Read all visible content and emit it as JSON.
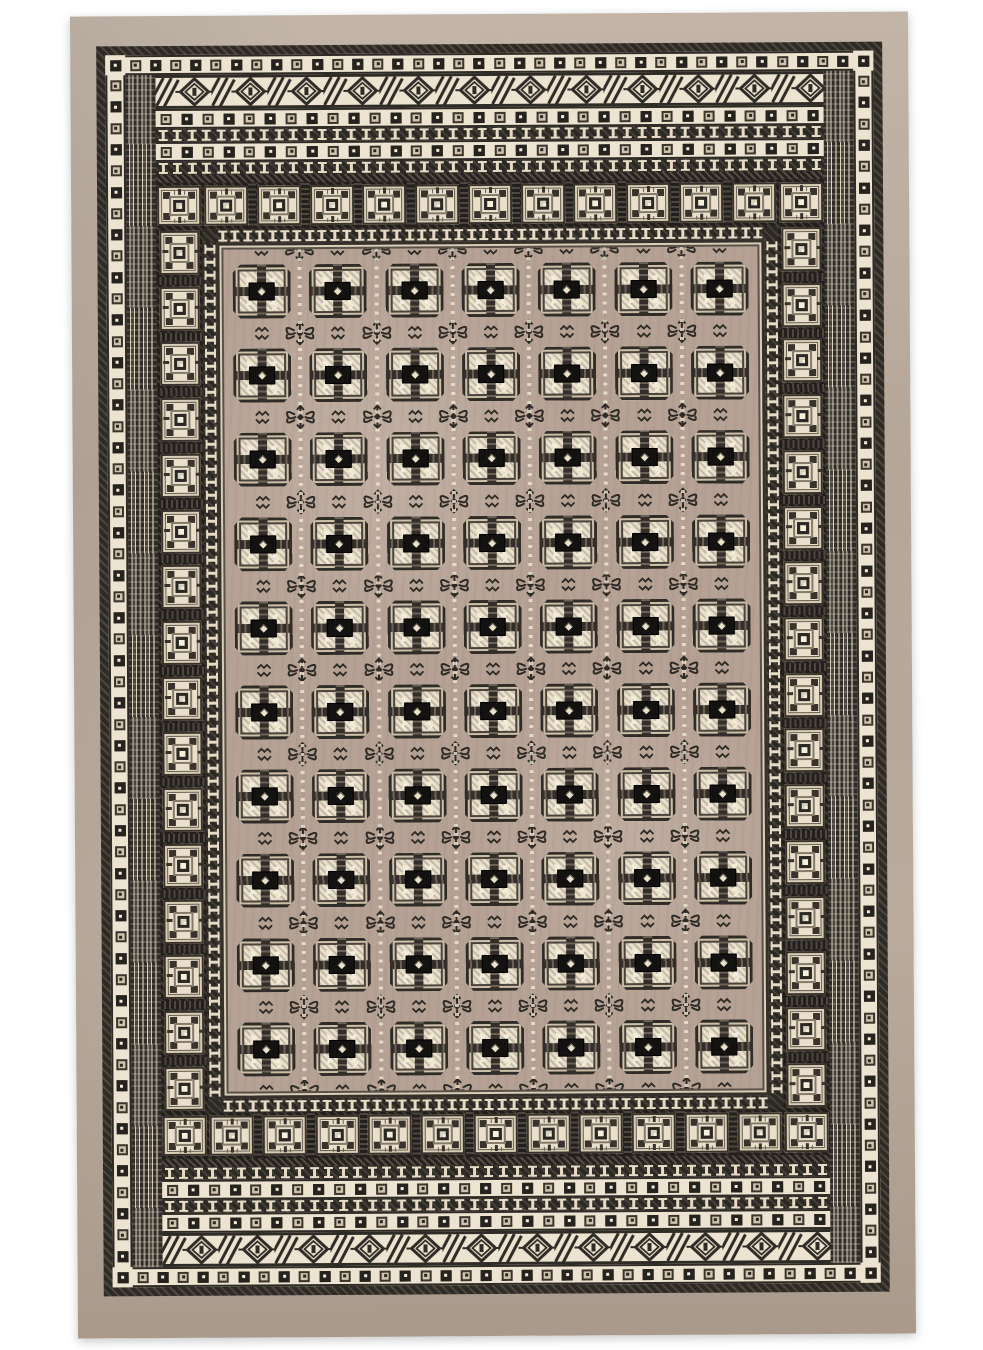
{
  "image": {
    "type": "product-photograph",
    "subject": "Bokhara-style area rug, beige and cream with black geometric pattern",
    "page_background": "#ffffff"
  },
  "rug": {
    "colors": {
      "page-bg": "#ffffff",
      "beige": "#b5a698",
      "beige-light": "#c2b5a8",
      "cream": "#ece3d0",
      "cream-bright": "#f4eddb",
      "dark": "#2e2a25",
      "dark-2": "#4d463e",
      "gray": "#8d8475",
      "taupe": "#b6a295",
      "med-cream": "#e9dfca",
      "black": "#141210"
    },
    "counts": {
      "rosette_ring_h": 36,
      "rosette_ring_v": 56,
      "rosette_inner_h": 32,
      "iband_h": 46,
      "iring_h": 44,
      "iring_v": 66,
      "tiles_h": 11,
      "tiles_v": 16,
      "field_rows": 10,
      "field_cols": 7
    },
    "structure": {
      "borders_outside_in": [
        "plain beige edge",
        "dark hatched guard stripe",
        "cream rosette band (alternating dark and outlined squares)",
        "cream-and-black tribal zigzag diamond band (top and bottom)",
        "cream rosette band",
        "dark band with small cream I-motifs",
        "cream rosette band",
        "dark guard",
        "border of cream square tiles with geometric centers",
        "dark band with small cream I-motifs",
        "field"
      ],
      "field": "taupe ground with 7 columns x 10 rows of octagonal guls; each gul cream with dark cross, black center block and white diamond dot; curled-hook cross ornaments and small zigzag squiggles between guls; dotted cream lines between columns"
    }
  }
}
